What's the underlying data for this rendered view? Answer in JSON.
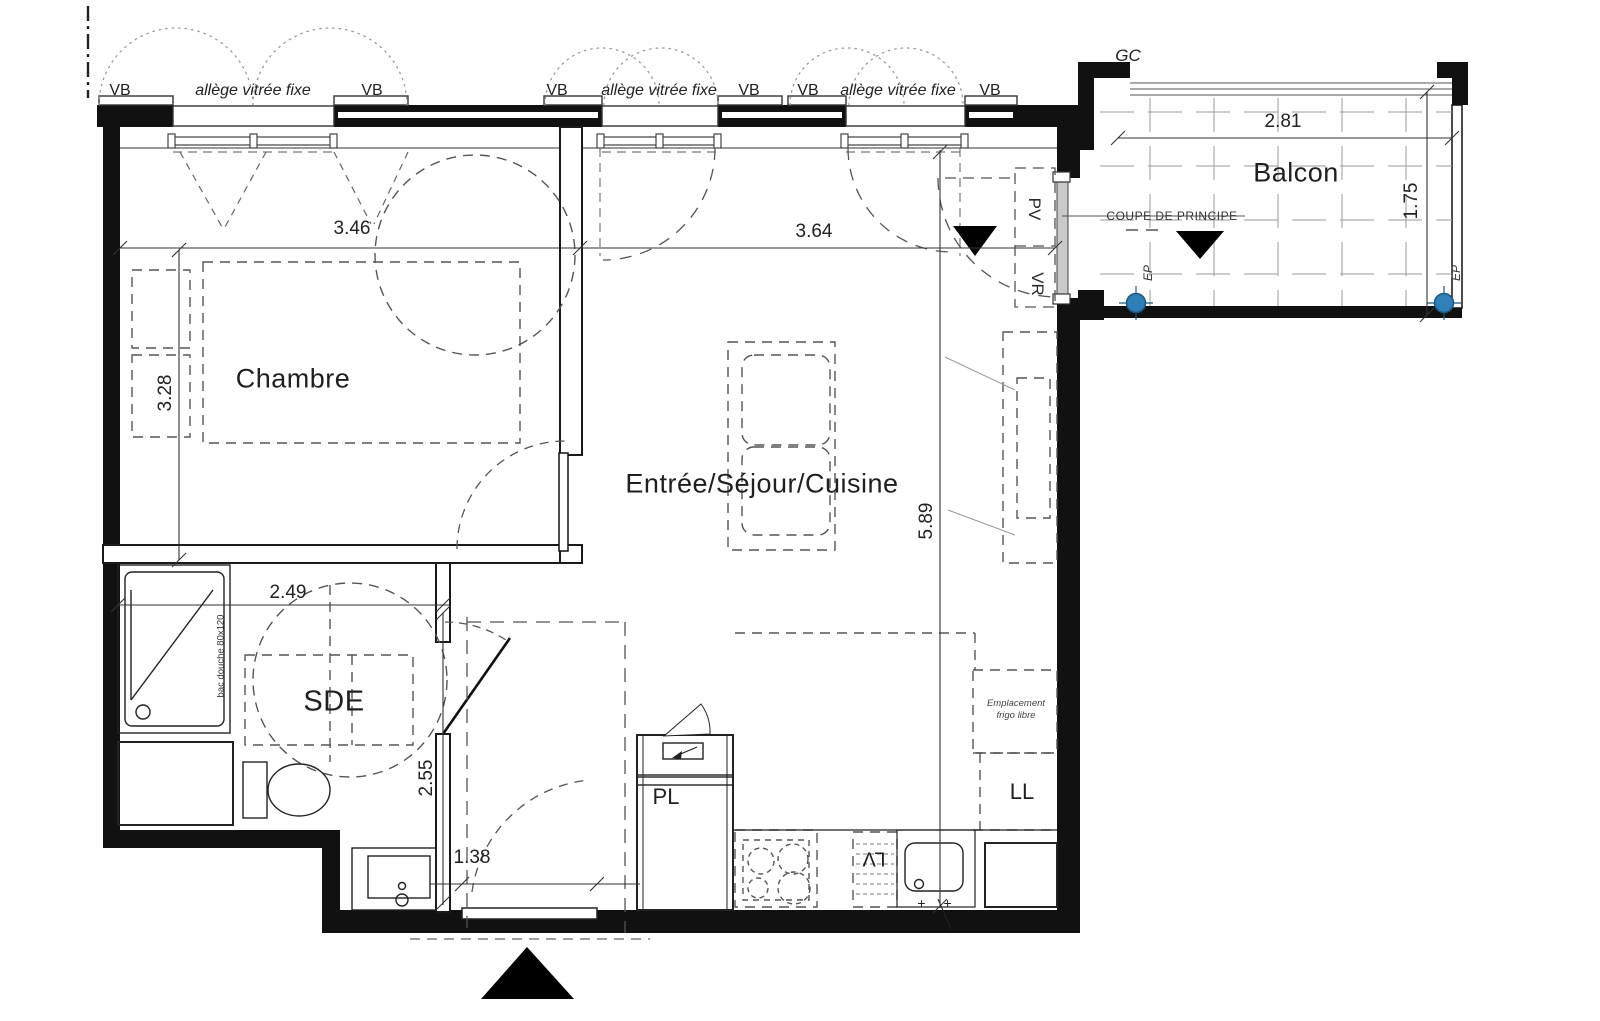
{
  "plan": {
    "rooms": [
      {
        "name": "Chambre"
      },
      {
        "name": "Entrée/Séjour/Cuisine"
      },
      {
        "name": "SDE"
      },
      {
        "name": "Balcon"
      }
    ],
    "window_labels": {
      "vb": "VB",
      "fixed_glazing": "allège vitrée fixe"
    },
    "dimensions": {
      "chambre_width": "3.46",
      "sejour_width": "3.64",
      "chambre_depth": "3.28",
      "sejour_depth": "5.89",
      "sde_width": "2.49",
      "sde_depth": "2.55",
      "entrance_door_width": "1.38",
      "balcony_width": "2.81",
      "balcony_depth": "1.75"
    },
    "annotations": {
      "gutter": "GC",
      "section_label": "COUPE DE PRINCIPE",
      "rain_drain": "EP",
      "door_pv": "PV",
      "shutter_vr": "VR",
      "closet": "PL",
      "washing_machine": "LL",
      "dishwasher": "LV",
      "fridge_space_line1": "Emplacement",
      "fridge_space_line2": "frigo libre",
      "shower_tray": "bac douche 80x120",
      "sink_taps": "+ +"
    }
  }
}
